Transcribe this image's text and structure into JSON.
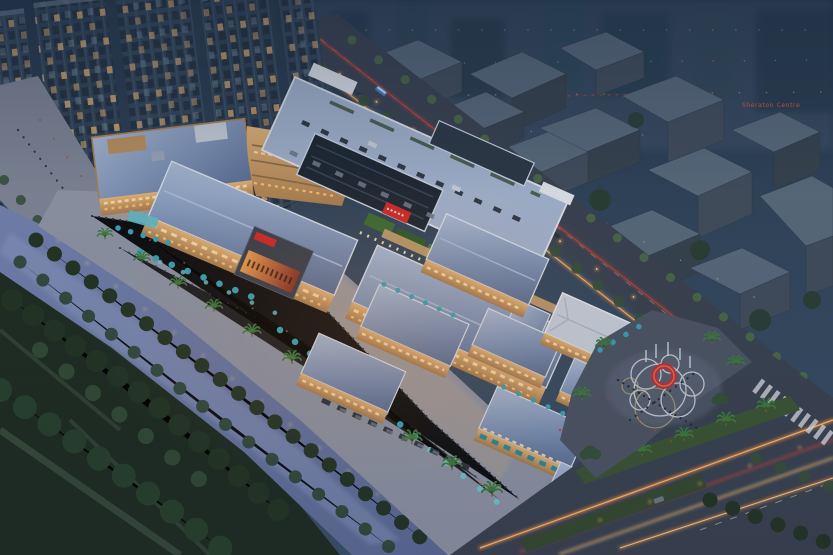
{
  "meta": {
    "type": "architectural-aerial-rendering",
    "time_of_day": "dusk",
    "subject": "riverside retail mall complex with waterfront promenade, rooftop parking deck, retail pavilions, event plaza and arterial roads"
  },
  "signs": {
    "distant_hotel": "Sheraton Centre"
  },
  "scene": {
    "elements": [
      {
        "name": "residential-towers",
        "description": "tall apartment slabs with lit windows, upper left"
      },
      {
        "name": "pedestrian-walkway",
        "description": "gray tree-lined walkway with people, left edge"
      },
      {
        "name": "river",
        "description": "diagonal canal with wooded banks and shore lights"
      },
      {
        "name": "riverside-park",
        "description": "dark tree park with paths, lower left"
      },
      {
        "name": "waterfront-promenade",
        "description": "palm-lined promenade with teal umbrellas and crowds"
      },
      {
        "name": "hotel-block",
        "description": "five-storey curved hotel with warm lit windows"
      },
      {
        "name": "anchor-roof-deck",
        "description": "rooftop parking deck with central skylight and cars"
      },
      {
        "name": "retail-street-roofs",
        "description": "large slate-blue pitched roofs over lit storefronts"
      },
      {
        "name": "cinema-led-screen",
        "description": "dark box with warm LED billboard"
      },
      {
        "name": "retail-pavilions",
        "description": "two-storey shop pavilions with blue roofs and teal awnings"
      },
      {
        "name": "event-plaza",
        "description": "plaza with red ring sculpture, fountain and painted circles"
      },
      {
        "name": "arterial-roads",
        "description": "dusk roads with orange traffic light-trails, medians, crosswalk"
      },
      {
        "name": "city-massing",
        "description": "untextured gray-blue block models of surrounding city"
      }
    ]
  },
  "palette": {
    "sky_top": "#26364a",
    "sky_mid": "#33465c",
    "backdrop_haze": "#41566b",
    "tower_facade": "#34465a",
    "tower_cap": "#5a6c7e",
    "window_dim": "#22303f",
    "window_lit": "#e9b672",
    "window_cool": "#9db6c8",
    "massing_top": "#58697a",
    "massing_side": "#414d5b",
    "massing_dark": "#37424e",
    "city_tree": "#2a3d31",
    "road_asphalt": "#3a4250",
    "road_edge": "#2f3642",
    "trail_orange": "#ff8f3e",
    "trail_amber": "#ffc070",
    "trail_red": "#d94436",
    "trail_white": "#e8e4d6",
    "streetlight": "#ffaf4e",
    "verge_green": "#3c5434",
    "tree_dark": "#233423",
    "tree_mid": "#36503a",
    "tree_light": "#4f7046",
    "park_ground": "#1e2c21",
    "park_path": "#3d4f40",
    "river": "#7280ac",
    "river_deep": "#5c6a95",
    "river_sheen": "#97a4c9",
    "shore_light": "#ffd876",
    "walkway": "#7e8494",
    "promenade": "#8e93a3",
    "promenade_warm": "#bda68d",
    "people_dark": "#23282f",
    "people_red": "#b5443a",
    "umbrella_teal": "#38a2b4",
    "umbrella_lite": "#6fc6d4",
    "awning_teal": "#2b8a9c",
    "palm_frond": "#3f7a3c",
    "palm_dark": "#2c5a2e",
    "roof_slate": "#7c90b3",
    "roof_slate_lt": "#a9b9d3",
    "roof_slate_dk": "#5a6d92",
    "roof_white": "#d8dde7",
    "deck_top": "#a2b1cb",
    "deck_line": "#8fa0bd",
    "deck_green": "#3e5340",
    "skylight_dark": "#1e2732",
    "skylight_frame": "#c9d2e0",
    "white_wall": "#dde1e9",
    "hotel_tan": "#c49a68",
    "hotel_parapet": "#b08050",
    "facade_warm": "#e2b277",
    "glow_warm": "#ffd9a0",
    "storefront": "#ffc472",
    "sign_red": "#ce2a28",
    "billboard_green": "#3c6b33",
    "billboard_green2": "#2e5a2a",
    "cinema_dark": "#3a3f4b",
    "screen_warm": "#e89b4e",
    "screen_deep": "#8a3326",
    "plaza_dark": "#4d5564",
    "plaza_lite": "#667083",
    "circle_paint": "#d8dce3",
    "circle_gold": "#d6c67a",
    "ring_red": "#c13230",
    "fountain": "#d5e6ec",
    "car_dark": "#2b333e",
    "car_gray": "#6e7886",
    "car_white": "#c9cfd8",
    "bus_blue": "#4a7fc0",
    "sheraton_red": "#ef5340",
    "overlay_dusk": "#16243a",
    "warm_glow": "#ff9f50"
  }
}
